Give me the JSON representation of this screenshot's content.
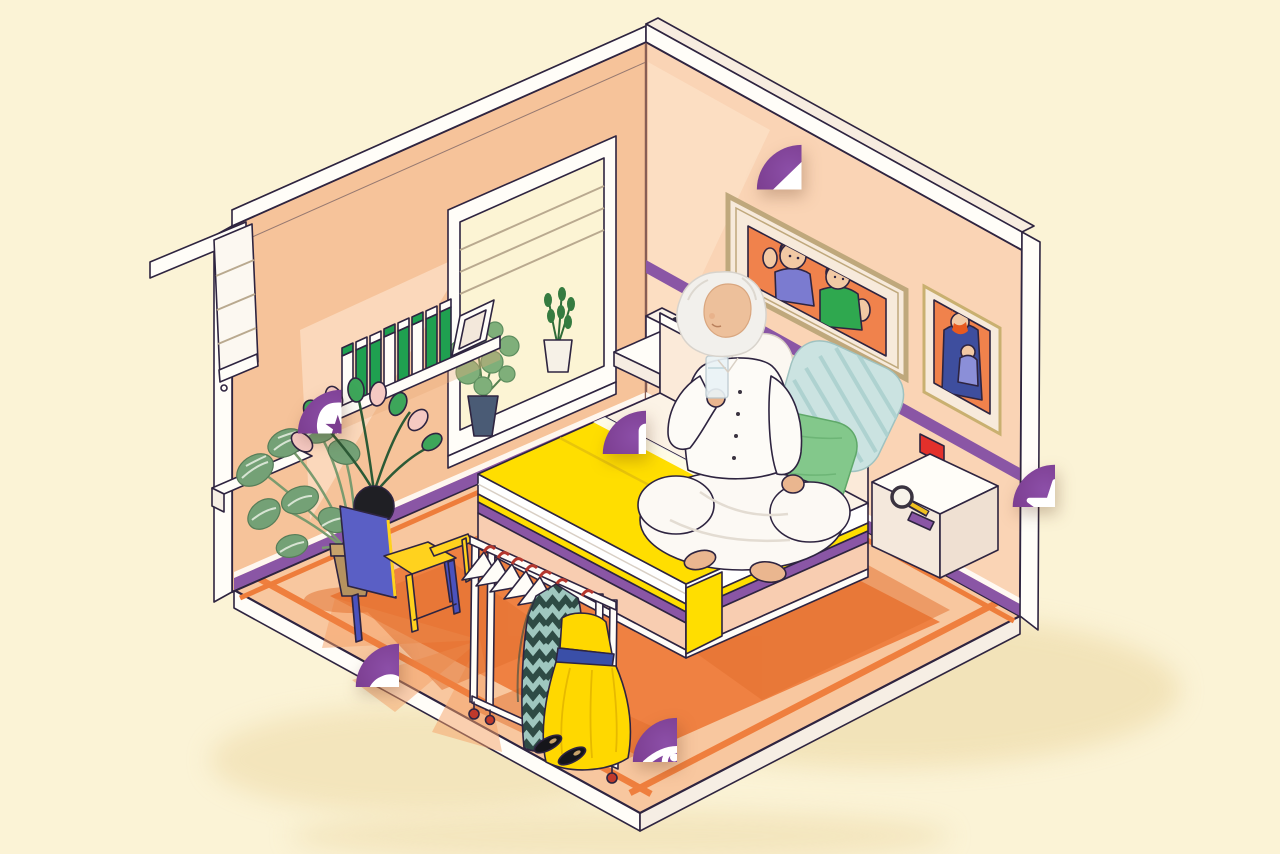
{
  "canvas": {
    "width": 1280,
    "height": 854
  },
  "palette": {
    "background": "#FBF3D6",
    "icon_purple": "#7B3D8F",
    "icon_purple_dark": "#6C2F84",
    "wall_peach": "#F6C39A",
    "wall_peach_light": "#FAD4B5",
    "wall_highlight": "#FDE4CC",
    "floor_base": "#F8C79F",
    "rug_orange": "#EF8142",
    "shadow_orange": "#E26F2D",
    "bed_yellow": "#FFDE00",
    "stripe_purple": "#8A56A5",
    "book_green": "#1FA050",
    "chair_blue": "#5A5FC5",
    "chair_yellow": "#FFD21E",
    "pillow_blue": "#CBE3E1",
    "pillow_green": "#83C88B",
    "accent_red": "#E3302B",
    "frame_gold": "#BFA87C",
    "picture_orange": "#F0824C"
  },
  "hotspots": [
    {
      "name": "home-heart",
      "glyph": "glyph-house-heart",
      "x": 754,
      "y": 142,
      "size": 95
    },
    {
      "name": "mind-star",
      "glyph": "glyph-head-star",
      "x": 295,
      "y": 387,
      "size": 93
    },
    {
      "name": "alert-exclamation",
      "glyph": "glyph-exclamation",
      "x": 600,
      "y": 408,
      "size": 92
    },
    {
      "name": "favorite-star",
      "glyph": "glyph-star",
      "x": 1010,
      "y": 462,
      "size": 90
    },
    {
      "name": "strength-muscle",
      "glyph": "glyph-muscle-arm",
      "x": 353,
      "y": 641,
      "size": 92
    },
    {
      "name": "vision-eye",
      "glyph": "glyph-eye",
      "x": 630,
      "y": 715,
      "size": 94
    }
  ],
  "scene": {
    "description": "Isometric cutaway bedroom: senior woman in white pajamas sits cross-legged on a yellow bed holding a glass of water; window with plants, bookshelf with green books, blue-and-yellow armchair, clothes rack with dress and coat, framed family portraits; six purple wellness icons float over the scene.",
    "elements": [
      "bedroom",
      "bed",
      "pillows",
      "senior-woman",
      "glass-of-water",
      "window",
      "roller-blind",
      "bookshelf",
      "books",
      "picture-frames",
      "family-portraits",
      "armchair",
      "potted-plants",
      "clothes-rack",
      "hangers",
      "yellow-dress",
      "patterned-coat",
      "shoes",
      "alarm-clock",
      "table-lamps",
      "magnifying-glass",
      "nightstands",
      "light-switch",
      "rug"
    ]
  }
}
